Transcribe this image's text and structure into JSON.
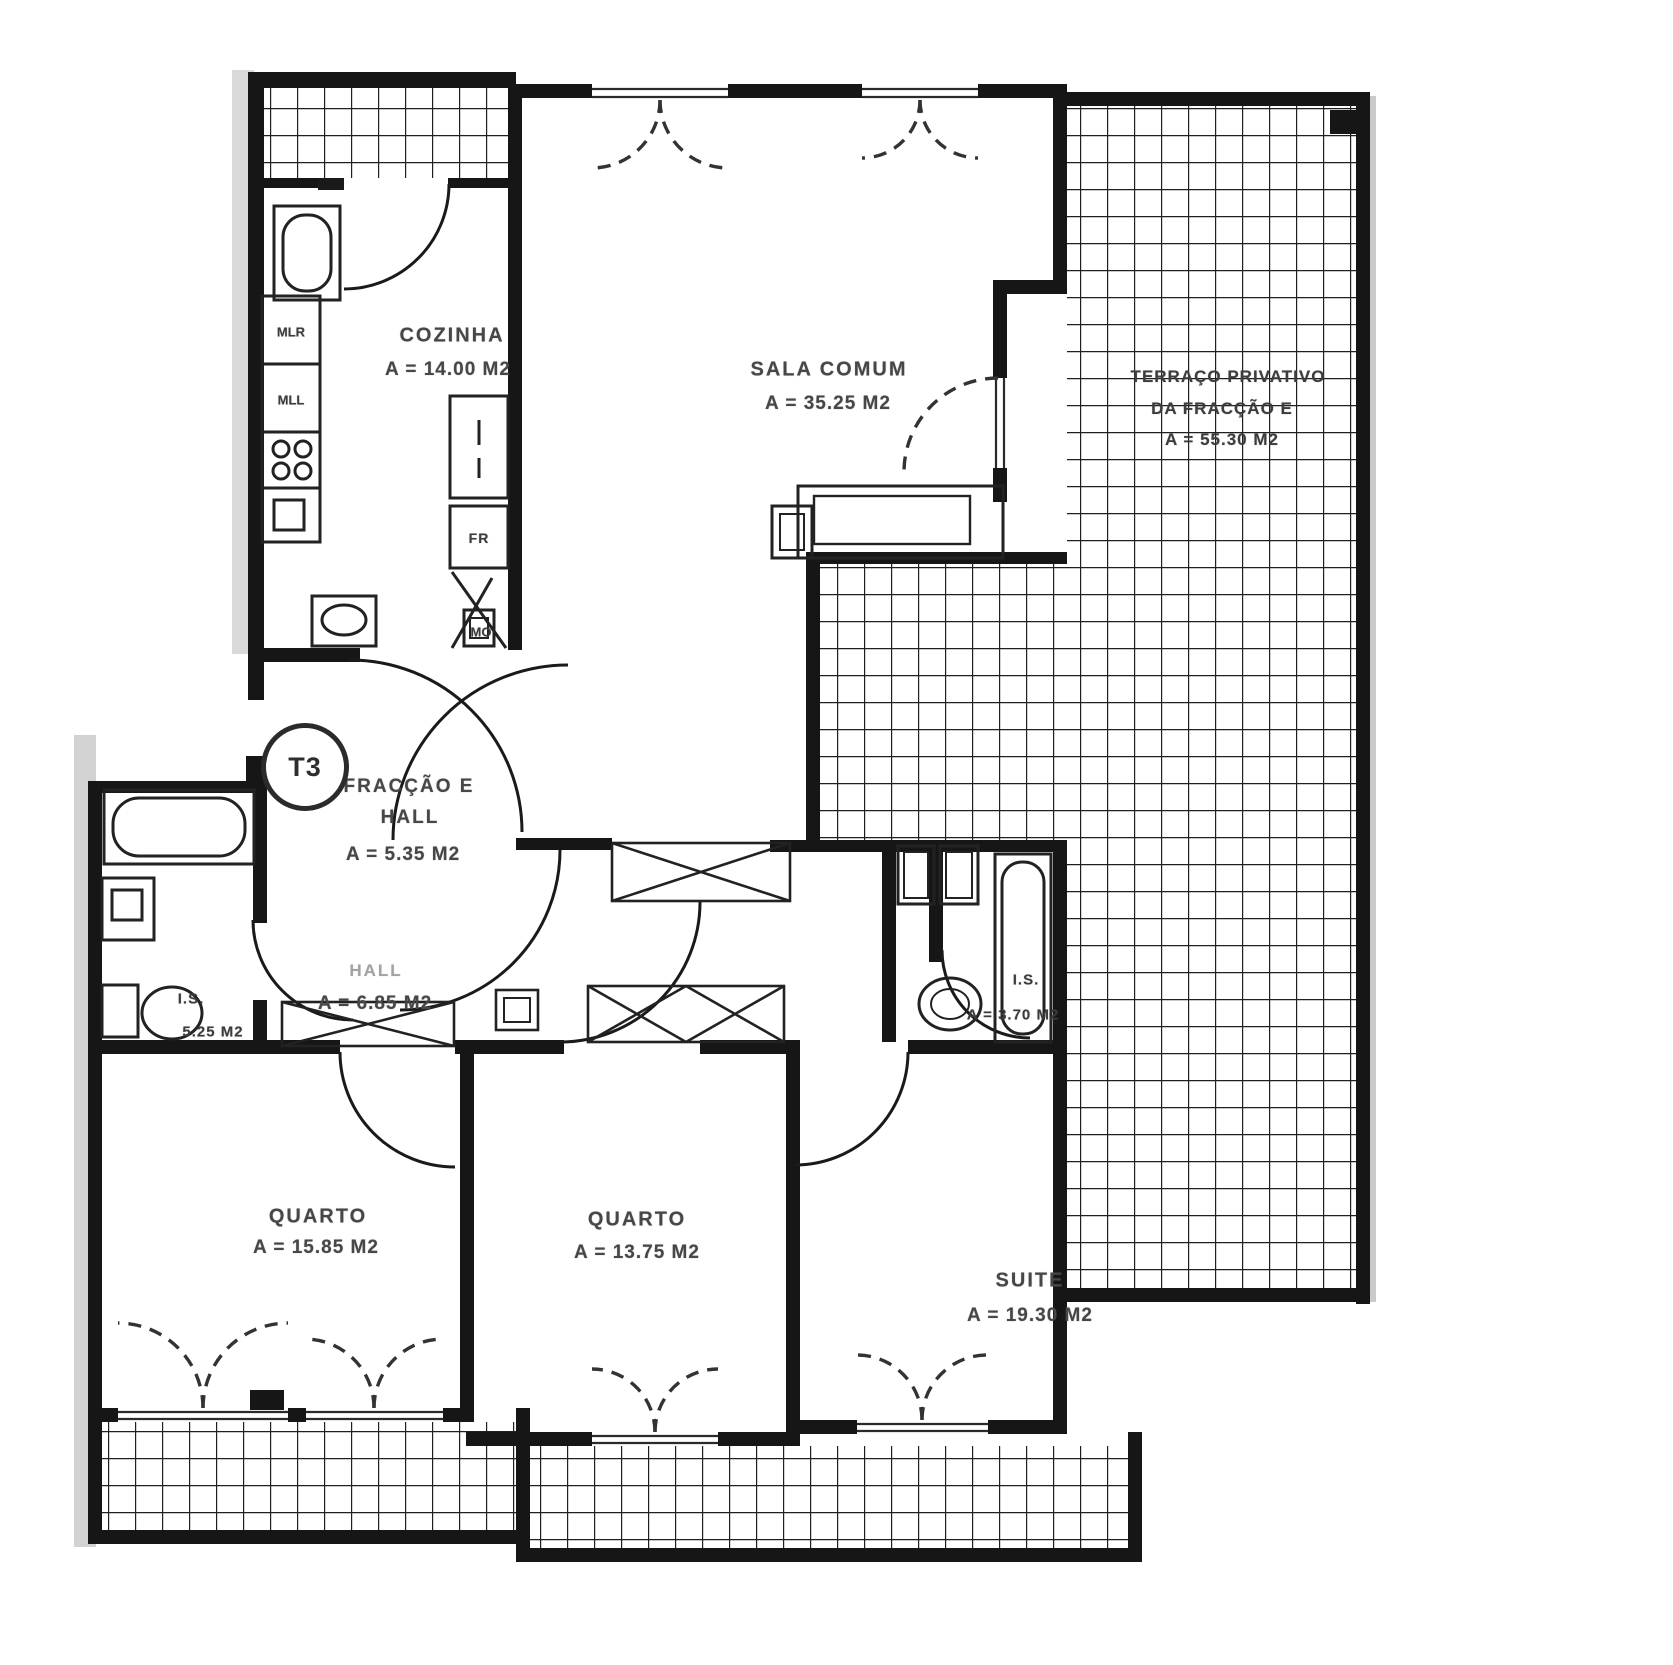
{
  "plan": {
    "badge": "T3",
    "rooms": {
      "cozinha": {
        "label": "COZINHA",
        "area": "A = 14.00 M2"
      },
      "sala_comum": {
        "label": "SALA COMUM",
        "area": "A = 35.25 M2"
      },
      "terraco": {
        "line1": "TERRAÇO PRIVATIVO",
        "line2": "DA FRACÇÃO E",
        "area": "A = 55.30 M2"
      },
      "entry_hall": {
        "line1": "FRACÇÃO E",
        "line2": "HALL",
        "area": "A = 5.35 M2"
      },
      "hall": {
        "label": "HALL",
        "area": "A = 6.85 M2"
      },
      "is1": {
        "label": "I.S.",
        "area": "5.25 M2"
      },
      "is2": {
        "label": "I.S.",
        "area": "A = 3.70 M2"
      },
      "quarto1": {
        "label": "QUARTO",
        "area": "A = 15.85 M2"
      },
      "quarto2": {
        "label": "QUARTO",
        "area": "A = 13.75 M2"
      },
      "suite": {
        "label": "SUITE",
        "area": "A = 19.30 M2"
      }
    },
    "appliances": {
      "mlr": "MLR",
      "mll": "MLL",
      "fr": "FR",
      "mo": "MO"
    },
    "ink": "#161616"
  }
}
